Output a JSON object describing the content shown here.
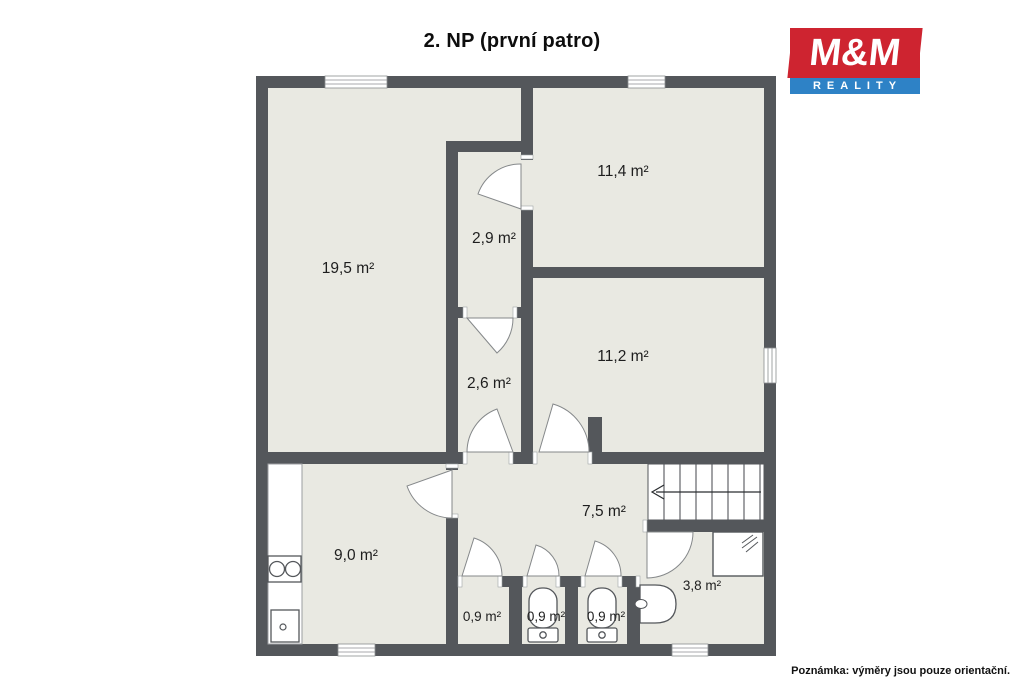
{
  "title": "2. NP (první patro)",
  "logo": {
    "top": "M&M",
    "bottom": "REALITY",
    "red": "#ce2430",
    "blue": "#2e82c6"
  },
  "note": "Poznámka: výměry jsou pouze orientační.",
  "floor": {
    "wall_color": "#54575b",
    "room_color": "#e9e9e2",
    "rooms": [
      {
        "id": "room-19-5",
        "label": "19,5 m²"
      },
      {
        "id": "room-2-9",
        "label": "2,9 m²"
      },
      {
        "id": "room-11-4",
        "label": "11,4 m²"
      },
      {
        "id": "room-11-2",
        "label": "11,2 m²"
      },
      {
        "id": "room-2-6",
        "label": "2,6 m²"
      },
      {
        "id": "hall-7-5",
        "label": "7,5 m²"
      },
      {
        "id": "kitchen-9-0",
        "label": "9,0 m²"
      },
      {
        "id": "wc-1",
        "label": "0,9 m²"
      },
      {
        "id": "wc-2",
        "label": "0,9 m²"
      },
      {
        "id": "wc-3",
        "label": "0,9 m²"
      },
      {
        "id": "bath-3-8",
        "label": "3,8 m²"
      }
    ],
    "fixtures": [
      "staircase",
      "shower",
      "washbasin",
      "toilet",
      "toilet",
      "cooktop",
      "kitchen-sink",
      "kitchen-counter"
    ],
    "windows_count": 5,
    "doors_count": 9
  }
}
